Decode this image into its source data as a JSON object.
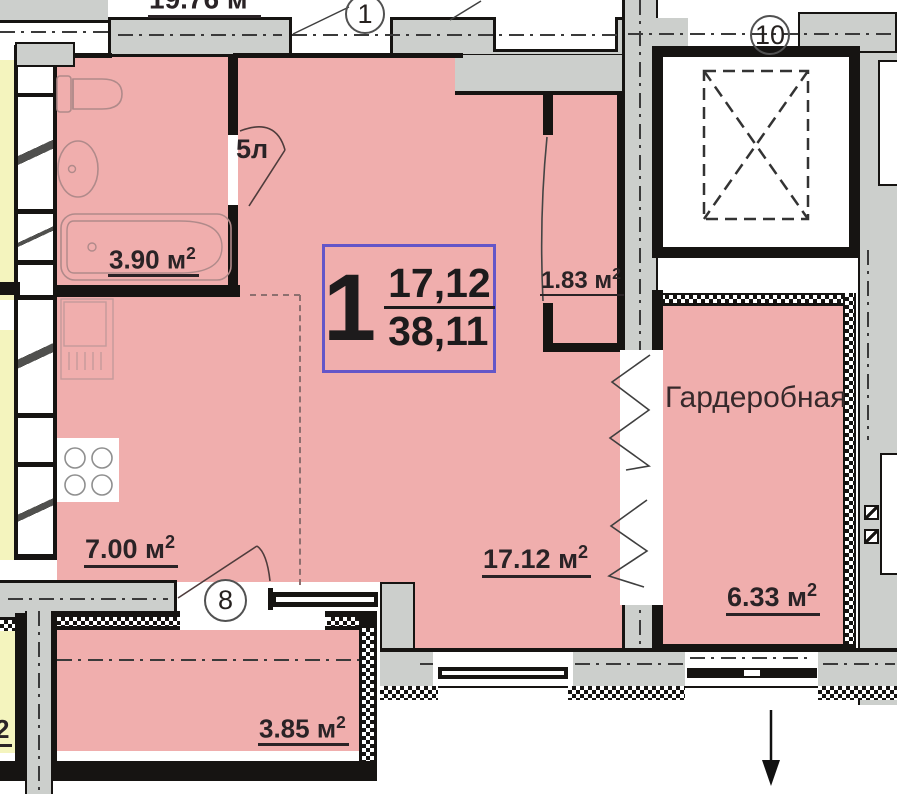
{
  "floor_plan": {
    "badge": {
      "number": "1",
      "upper": "17,12",
      "lower": "38,11"
    },
    "labels": {
      "room_top": {
        "text": "19.76 м",
        "sup": "2"
      },
      "bathroom": {
        "text": "3.90 м",
        "sup": "2"
      },
      "closet": {
        "text": "1.83 м",
        "sup": "2"
      },
      "kitchen": {
        "text": "7.00 м",
        "sup": "2"
      },
      "living": {
        "text": "17.12 м",
        "sup": "2"
      },
      "wardrobe_name": "Гардеробная",
      "wardrobe_area": {
        "text": "6.33 м",
        "sup": "2"
      },
      "balcony": {
        "text": "3.85 м",
        "sup": "2"
      },
      "left_fragment": "2",
      "door_bathroom": "5л"
    },
    "axes": {
      "top": "1",
      "right": "10",
      "bottom": "8"
    },
    "colors": {
      "room_fill": "#f0aead",
      "adjacent_fill": "#f4f4be",
      "wall_fill": "#cccfcc",
      "wall_outline": "#161412",
      "badge_border": "#6456c8",
      "text": "#2a2326"
    }
  }
}
